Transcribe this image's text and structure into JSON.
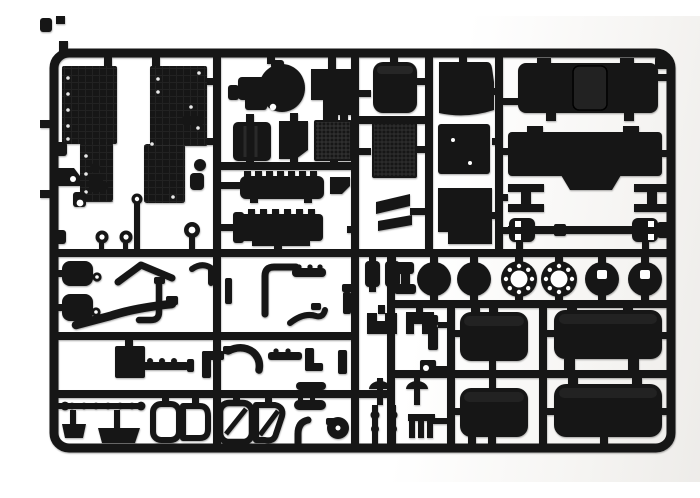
{
  "scene": {
    "type": "product-photo",
    "subject": "injection-molded plastic model kit sprue with truck parts",
    "aria_label": "Photograph of a black injection-molded plastic model kit sprue on a white background, holding truck model parts: cab floor panels, engine block, radiator grille, seats, roof panel with sunroof, cab rear panel, axle beams, driveshaft, wheel hubs and brake drums, four fuel tanks, exhaust pipes, fenders, mud flaps, air horns and small fittings.",
    "background_color": "#ffffff",
    "background_shade_right": "#ebe9e6",
    "plastic_color": "#161616",
    "plastic_highlight": "#2d2d2d",
    "cutout_color": "#ffffff"
  },
  "sprue": {
    "material": "black styrene plastic",
    "frame_shape": "rounded rectangle with internal runner grid",
    "part_groups": [
      {
        "name": "cab-floor-panel",
        "qty": 2
      },
      {
        "name": "engine-block",
        "qty": 1
      },
      {
        "name": "gearbox-housing",
        "qty": 1
      },
      {
        "name": "equipment-box",
        "qty": 3
      },
      {
        "name": "ribbed-chassis-member",
        "qty": 2
      },
      {
        "name": "seat-cushion",
        "qty": 1
      },
      {
        "name": "seat-back",
        "qty": 1
      },
      {
        "name": "radiator-grille",
        "qty": 1
      },
      {
        "name": "storage-box",
        "qty": 2
      },
      {
        "name": "roof-panel-with-sunroof",
        "qty": 1
      },
      {
        "name": "cab-rear-panel",
        "qty": 1
      },
      {
        "name": "axle-beam",
        "qty": 2
      },
      {
        "name": "driveshaft",
        "qty": 1
      },
      {
        "name": "brake-drum-disc",
        "qty": 2
      },
      {
        "name": "hub-flange-with-bolt-holes",
        "qty": 2
      },
      {
        "name": "hub-cap-disc",
        "qty": 2
      },
      {
        "name": "fuel-tank",
        "qty": 4
      },
      {
        "name": "air-tank-cylinder",
        "qty": 2
      },
      {
        "name": "brake-chamber",
        "qty": 2
      },
      {
        "name": "exhaust-pipe",
        "qty": 6
      },
      {
        "name": "battery-box",
        "qty": 1
      },
      {
        "name": "tie-rod",
        "qty": 1
      },
      {
        "name": "mud-flap",
        "qty": 2
      },
      {
        "name": "hollow-fender-outline",
        "qty": 4
      },
      {
        "name": "air-horn",
        "qty": 2
      },
      {
        "name": "gear-lever",
        "qty": 2
      },
      {
        "name": "step-comb",
        "qty": 1
      },
      {
        "name": "turbocharger",
        "qty": 1
      },
      {
        "name": "small-bracket",
        "qty": 12
      }
    ]
  }
}
